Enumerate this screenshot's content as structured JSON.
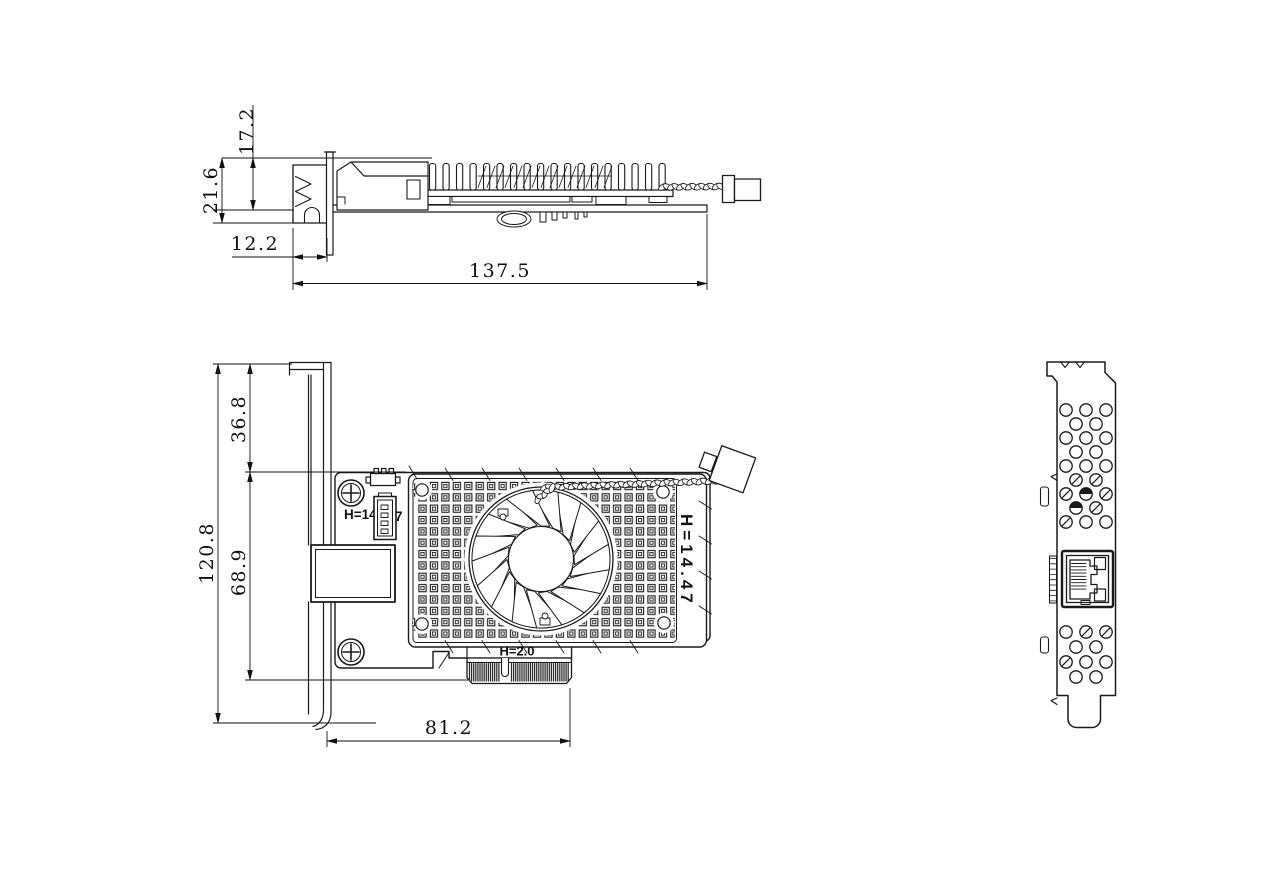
{
  "drawing": {
    "title": "PCIe network adapter card - dimensional drawing",
    "colors": {
      "background": "#ffffff",
      "line": "#1a1a1a"
    },
    "side_view": {
      "name": "side-profile-view",
      "dimensions": {
        "heatsink_top_to_pcb": "17.2",
        "overall_height": "21.6",
        "port_protrusion": "12.2",
        "card_length": "137.5"
      }
    },
    "front_view": {
      "name": "front-component-view",
      "dimensions": {
        "bracket_top_to_pcb_top": "36.8",
        "pcb_top_to_card_bottom": "68.9",
        "bracket_height": "120.8",
        "bracket_to_connector_end": "81.2"
      },
      "labels": {
        "fan_header_prefix": "H=14.",
        "fan_header_suffix": "7",
        "edge_connector_height": "H=2.0",
        "fan_assembly_height": "H=14.47"
      }
    },
    "rear_view": {
      "name": "bracket-rear-view"
    }
  }
}
